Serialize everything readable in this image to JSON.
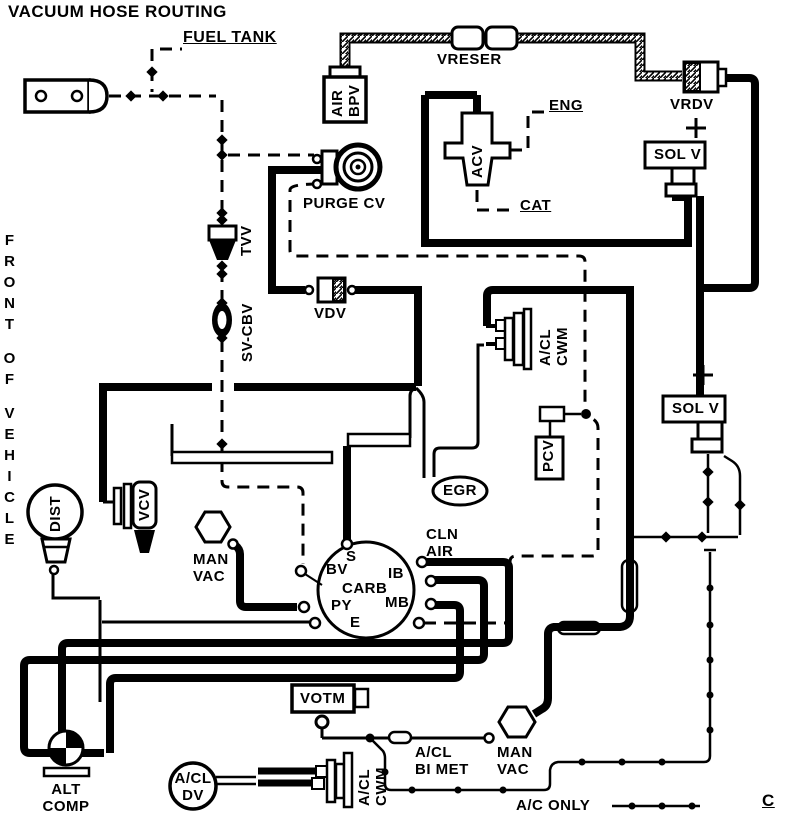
{
  "title": "VACUUM HOSE ROUTING",
  "orientation": {
    "front_of_vehicle": [
      "FRONT",
      "OF",
      "VEHICLE"
    ]
  },
  "labels": {
    "fuel_tank": "FUEL TANK",
    "vreser": "VRESER",
    "air_bpv": [
      "AIR",
      "BPV"
    ],
    "vrdv": "VRDV",
    "eng": "ENG",
    "acv": "ACV",
    "cat": "CAT",
    "sol_v_top": "SOL V",
    "sol_v_right": "SOL V",
    "purge_cv": "PURGE CV",
    "tvv": "TVV",
    "sv_cbv": "SV-CBV",
    "vdv": "VDV",
    "acl_cwm_upper": [
      "A/CL",
      "CWM"
    ],
    "pcv": "PCV",
    "dist": "DIST",
    "vcv": "VCV",
    "egr": "EGR",
    "man_vac_center": [
      "MAN",
      "VAC"
    ],
    "cln_air": [
      "CLN",
      "AIR"
    ],
    "carb": {
      "name": "CARB",
      "ports": {
        "s": "S",
        "bv": "BV",
        "py": "PY",
        "e": "E",
        "ib": "IB",
        "mb": "MB"
      }
    },
    "votm": "VOTM",
    "acl_bi_met": [
      "A/CL",
      "BI MET"
    ],
    "man_vac_bottom": [
      "MAN",
      "VAC"
    ],
    "acl_cwm_lower": [
      "A/CL",
      "CWM"
    ],
    "acl_dv": [
      "A/CL",
      "DV"
    ],
    "alt_comp": [
      "ALT",
      "COMP"
    ],
    "ac_only": "A/C ONLY",
    "c": "C"
  },
  "colors": {
    "ink": "#000000",
    "background": "#ffffff"
  }
}
